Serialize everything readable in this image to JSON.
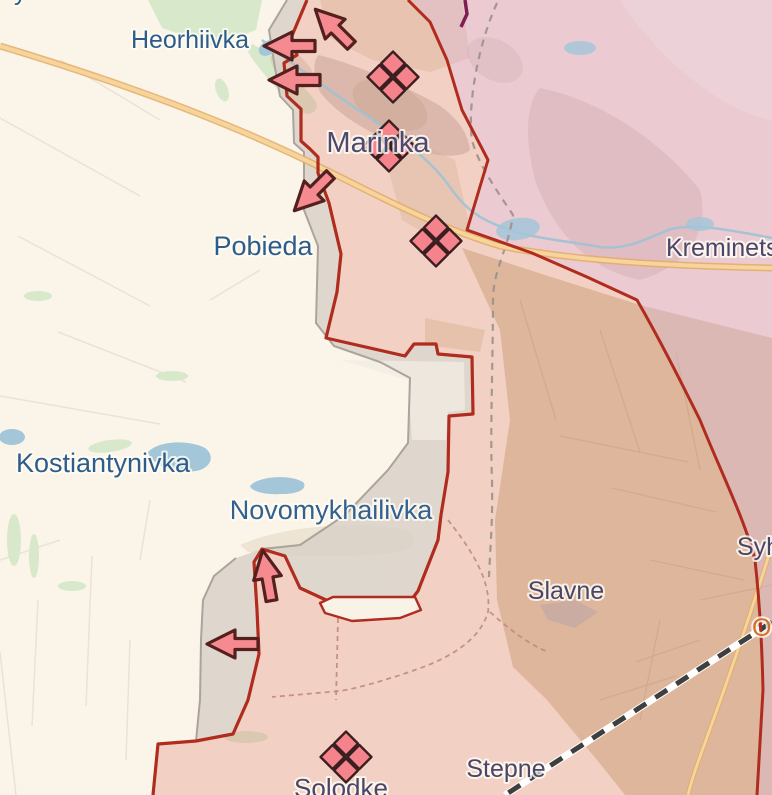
{
  "map": {
    "description": "Frontline situation map, Marinka direction (Donetsk oblast)",
    "labels": [
      {
        "id": "heorhiivka",
        "text": "Heorhiivka",
        "x": 190,
        "y": 48,
        "size": 25,
        "color": "#2D5C8C",
        "anchor": "middle"
      },
      {
        "id": "marinka",
        "text": "Marinka",
        "x": 378,
        "y": 152,
        "size": 29,
        "color": "#4C4870",
        "anchor": "middle"
      },
      {
        "id": "pobieda",
        "text": "Pobieda",
        "x": 263,
        "y": 255,
        "size": 27,
        "color": "#2D5C8C",
        "anchor": "middle"
      },
      {
        "id": "kostiantynivka",
        "text": "Kostiantynivka",
        "x": 103,
        "y": 472,
        "size": 27,
        "color": "#2D5C8C",
        "anchor": "middle"
      },
      {
        "id": "novomykhailivka",
        "text": "Novomykhailivka",
        "x": 331,
        "y": 519,
        "size": 27,
        "color": "#33618F",
        "anchor": "middle"
      },
      {
        "id": "slavne",
        "text": "Slavne",
        "x": 566,
        "y": 599,
        "size": 25,
        "color": "#4B4668",
        "anchor": "middle"
      },
      {
        "id": "stepne",
        "text": "Stepne",
        "x": 506,
        "y": 777,
        "size": 25,
        "color": "#4B4668",
        "anchor": "middle"
      },
      {
        "id": "solodke",
        "text": "Solodke",
        "x": 341,
        "y": 797,
        "size": 26,
        "color": "#4B4668",
        "anchor": "middle"
      },
      {
        "id": "kreminets",
        "text": "Kreminets",
        "x": 666,
        "y": 256,
        "size": 25,
        "color": "#4B4668",
        "anchor": "start"
      },
      {
        "id": "syhnalne",
        "text": "Syhnalne",
        "x": 737,
        "y": 555,
        "size": 25,
        "color": "#4B4668",
        "anchor": "start"
      },
      {
        "id": "partial-orange-label",
        "text": "O",
        "x": 752,
        "y": 636,
        "size": 25,
        "color": "#D2702B",
        "anchor": "start"
      },
      {
        "id": "partial-top-left-label",
        "text": "y",
        "x": 14,
        "y": 0,
        "size": 25,
        "color": "#2D5C8C",
        "anchor": "start"
      }
    ],
    "markers": {
      "clashes": [
        {
          "x": 393,
          "y": 77
        },
        {
          "x": 389,
          "y": 146
        },
        {
          "x": 436,
          "y": 241
        },
        {
          "x": 346,
          "y": 757
        }
      ],
      "arrows": [
        {
          "x": 333,
          "y": 27,
          "rotation": 45,
          "direction": "northwest"
        },
        {
          "x": 289,
          "y": 46,
          "rotation": 0,
          "direction": "west"
        },
        {
          "x": 294,
          "y": 80,
          "rotation": 0,
          "direction": "west"
        },
        {
          "x": 312,
          "y": 193,
          "rotation": -45,
          "direction": "southwest"
        },
        {
          "x": 267,
          "y": 575,
          "rotation": 80,
          "direction": "north"
        },
        {
          "x": 232,
          "y": 644,
          "rotation": 0,
          "direction": "west"
        }
      ]
    },
    "zones": [
      {
        "id": "ukrainian-controlled",
        "fill": "#FBF5E9"
      },
      {
        "id": "russian-advance",
        "fill": "#EFCFC5"
      },
      {
        "id": "occupied-pre-2022",
        "fill": "#EDD4DE"
      },
      {
        "id": "grey-zone",
        "fill": "#D8D0C7"
      }
    ],
    "lines": [
      {
        "id": "frontline",
        "style": "solid",
        "color": "#B02C1E"
      },
      {
        "id": "pre-invasion-contact-line",
        "style": "dashed",
        "color": "#9A9189"
      },
      {
        "id": "admin-boundary",
        "style": "dashed",
        "color": "#C08B7E"
      },
      {
        "id": "railway",
        "style": "dashed",
        "color": "#3F3F3F"
      },
      {
        "id": "highway",
        "style": "solid",
        "color": "#F3CE8F"
      }
    ],
    "colors": {
      "base": "#FBF5E9",
      "fields_khaki": "#D7C8A6",
      "khaki_line": "#C8B790",
      "field_line": "#EAE2D3",
      "advance_overlay": "rgba(224,138,120,0.33)",
      "occupied_overlay": "rgba(221,164,188,0.52)",
      "grey_zone": "#D8D0C7",
      "grey_edge": "#ABA49C",
      "frontline": "#B02C1E",
      "contact_line": "#9A9189",
      "admin_dash": "#C08B7E",
      "purple_line": "#7D1F52",
      "railway_dark": "#3F3F3F",
      "road": "#F6D49B",
      "road_casing": "#E2AC66",
      "water": "#A3C6D8",
      "stream": "#9FC2D4",
      "green": "#D8E8CB",
      "marker_fill": "#F5838B",
      "marker_stroke": "#3A1E20",
      "arrow_fill": "#F58B90",
      "arrow_stroke": "#54201E",
      "label_halo": "rgba(255,252,244,0.8)"
    }
  }
}
